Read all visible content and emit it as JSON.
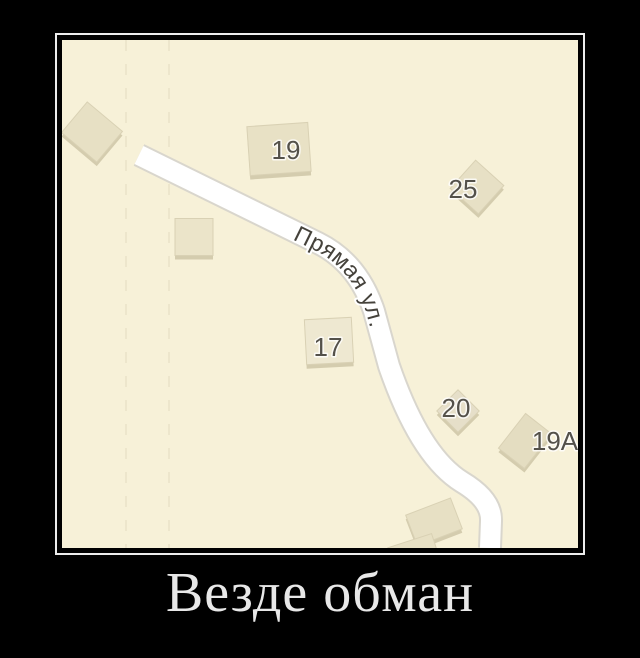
{
  "caption": {
    "text": "Везде обман",
    "color": "#e8e8e8"
  },
  "frame": {
    "border_color": "#ededed",
    "background": "#000000"
  },
  "map": {
    "background": "#f7f1d8",
    "boundary_color": "#ede6cc",
    "building_stroke": "#d9d1b4",
    "building_shadow": "#d4ccae",
    "label_color": "#54514a",
    "label_size": 26,
    "road": {
      "name": "Прямая ул.",
      "fill": "#ffffff",
      "casing": "#d9d6cd",
      "width": 20,
      "casing_width": 24,
      "label_color": "#45423b",
      "label_size": 23,
      "label_offset": "31%",
      "path": "M 77,115 L 256,203 Q 296,223 312,271 L 327,326 Q 358,416 400,442 Q 430,460 429,481 L 428,508"
    },
    "boundary_lines": [
      {
        "x": 64
      },
      {
        "x": 107
      }
    ],
    "buildings": [
      {
        "cx": 30,
        "cy": 92,
        "w": 46,
        "h": 40,
        "angle": 40,
        "fill": "#e7e0c4"
      },
      {
        "cx": 217,
        "cy": 109,
        "w": 61,
        "h": 49,
        "angle": -4,
        "fill": "#e8e1c5"
      },
      {
        "cx": 132,
        "cy": 197,
        "w": 38,
        "h": 37,
        "angle": 0,
        "fill": "#ebe4c9"
      },
      {
        "cx": 415,
        "cy": 147,
        "w": 38,
        "h": 38,
        "angle": 42,
        "fill": "#e7e0c5"
      },
      {
        "cx": 267,
        "cy": 301,
        "w": 47,
        "h": 45,
        "angle": -3,
        "fill": "#eee8d1"
      },
      {
        "cx": 396,
        "cy": 371,
        "w": 30,
        "h": 30,
        "angle": 45,
        "fill": "#e6dfc9"
      },
      {
        "cx": 463,
        "cy": 401,
        "w": 33,
        "h": 44,
        "angle": 38,
        "fill": "#e4ddc1"
      },
      {
        "cx": 372,
        "cy": 482,
        "w": 48,
        "h": 33,
        "angle": -21,
        "fill": "#e7e0c4"
      },
      {
        "cx": 352,
        "cy": 514,
        "w": 46,
        "h": 28,
        "angle": -18,
        "fill": "#e7e0c4"
      }
    ],
    "labels": [
      {
        "text": "19",
        "x": 224,
        "y": 110
      },
      {
        "text": "25",
        "x": 401,
        "y": 149
      },
      {
        "text": "17",
        "x": 266,
        "y": 307
      },
      {
        "text": "20",
        "x": 394,
        "y": 368
      },
      {
        "text": "19А",
        "x": 493,
        "y": 401
      }
    ]
  }
}
